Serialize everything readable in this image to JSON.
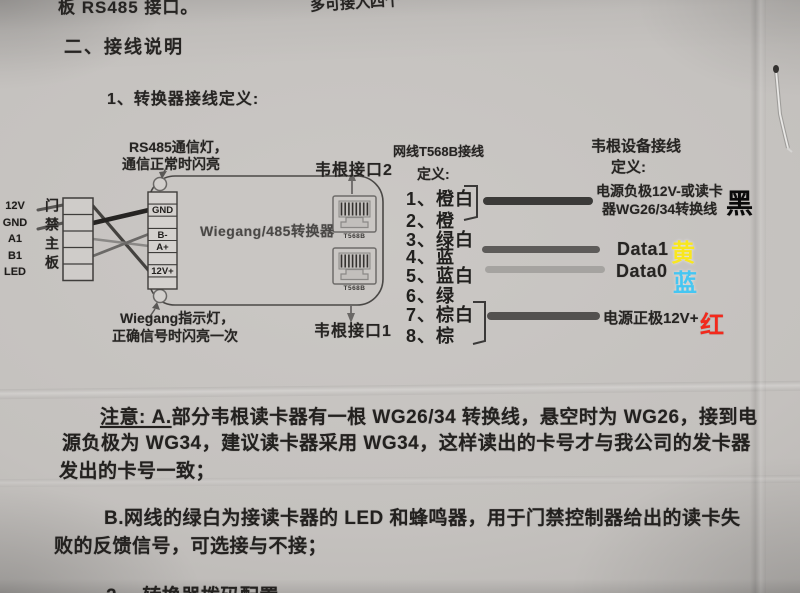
{
  "photo_fragments": {
    "top_left_partial": "板 RS485 接口。",
    "top_right_partial": "多可接入四个",
    "bottom_partial": "2、 转换器拨码配置"
  },
  "headings": {
    "section": "二、接线说明",
    "subsection": "1、转换器接线定义:"
  },
  "diagram": {
    "rs485_led_note_line1": "RS485通信灯，",
    "rs485_led_note_line2": "通信正常时闪亮",
    "wiegand_led_note_line1": "Wiegang指示灯，",
    "wiegand_led_note_line2": "正确信号时闪亮一次",
    "port2_label": "韦根接口2",
    "port1_label": "韦根接口1",
    "access_board_label": "门禁主板",
    "board_pins": [
      "12V",
      "GND",
      "A1",
      "B1",
      "LED"
    ],
    "converter_label": "Wiegang/485转换器",
    "converter_terminals": [
      "GND",
      "B-",
      "A+",
      "12V+"
    ],
    "rj45_jack_label": "T568B"
  },
  "t568b_column": {
    "title_line1": "网线T568B接线",
    "title_line2": "定义:",
    "wires": [
      "1、橙白",
      "2、橙",
      "3、绿白",
      "4、蓝",
      "5、蓝白",
      "6、绿",
      "7、棕白",
      "8、棕"
    ],
    "bar_colors": [
      "#3b3a38",
      "#5d5b59",
      "#a5a3a0",
      "#53514f"
    ]
  },
  "device_column": {
    "title_line1": "韦根设备接线",
    "title_line2": "定义:",
    "neg_line1": "电源负极12V-或读卡",
    "neg_line2": "器WG26/34转换线",
    "neg_color_char": "黑",
    "neg_color": "#0a0a0a",
    "data1_label": "Data1",
    "data1_color_char": "黄",
    "data1_color": "#f9e71e",
    "data0_label": "Data0",
    "data0_color_char": "蓝",
    "data0_color": "#45c6f2",
    "pos_label": "电源正极12V+",
    "pos_color_char": "红",
    "pos_color": "#f3291c"
  },
  "notes": {
    "a_prefix": "注意: A.",
    "a_lines": [
      "部分韦根读卡器有一根 WG26/34 转换线，悬空时为 WG26，接到电",
      "源负极为 WG34，建议读卡器采用 WG34，这样读出的卡号才与我公司的发卡器",
      "发出的卡号一致；"
    ],
    "b_prefix": "B.",
    "b_lines": [
      "网线的绿白为接读卡器的 LED 和蜂鸣器，用于门禁控制器给出的读卡失",
      "败的反馈信号，可选接与不接；"
    ]
  }
}
